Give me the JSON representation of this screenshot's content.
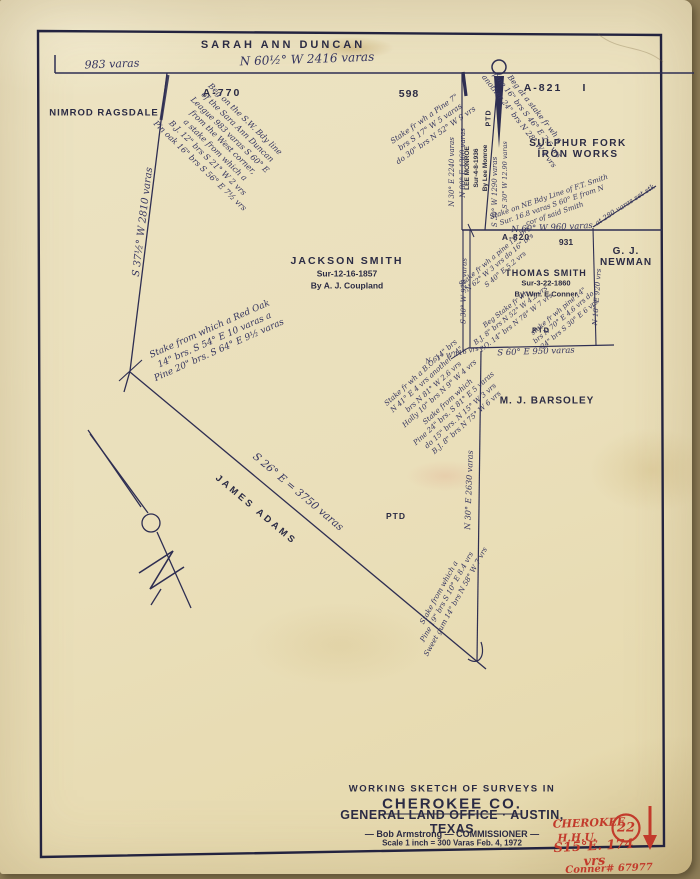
{
  "labels": {
    "sarah_ann_duncan": "SARAH ANN  DUNCAN",
    "nimrod_ragsdale": "NIMROD RAGSDALE",
    "a770": "A-770",
    "num_598": "598",
    "a821": "A-821",
    "roman_one": "I",
    "sulphur_fork": "SULPHUR FORK IRON WORKS",
    "jackson_smith_name": "JACKSON SMITH",
    "jackson_smith_sub": "Sur-12-16-1857\nBy A. J. Coupland",
    "lee_monroe": "LEE MONROE\nSur-4-8-1936\nBy Lee Monroe",
    "ptd_strip": "PTD",
    "a820": "A-820",
    "num_931": "931",
    "gj_newman": "G. J. NEWMAN",
    "thomas_smith_name": "THOMAS SMITH",
    "thomas_smith_sub": "Sur-3-22-1860\nBy Wm. E Conner",
    "ptd_block": "PTD",
    "mj_barsoley": "M. J. BARSOLEY",
    "james_adams": "JAMES ADAMS",
    "ptd_center": "PTD",
    "varas_983": "983 varas",
    "bearing_top": "N 60½° W  2416 varas",
    "bearing_left_line": "S 37½° W  2810 varas",
    "bearing_adams": "S 26° E  =  3750 varas",
    "bearing_v_2240": "N 30° E 2240 varas",
    "bearing_v_1360": "N 80° E 1360 varas",
    "bearing_v_1290a": "S 30° W 1290 varas",
    "bearing_v_1290b": "S 30° W 12.90 varas",
    "bearing_v_920": "S 30° W 920 varas",
    "bearing_v_block_right": "N 18° E 920 vrs",
    "bearing_960": "N 60° W 960 varas",
    "bearing_950": "S 60° E 950 varas",
    "bearing_116": "N 61° W 116 vrs",
    "bearing_v_2630": "N 30° E 2630 varas",
    "at_280": "at 280 varas set stk"
  },
  "notes": {
    "beg_sw": "Beg on the S.W. Bdy line\nof the Sara Ann Duncan\nLeague 983 varas S 60° E\nfrom the West corner,\na stake from which a\nB.J. 12\" brs S 21° W 2 vrs\nPin oak 16\" brs S 56° E 7½ vrs",
    "red_oak": "Stake from which a Red Oak\n14\" brs. S 54° E 10 varas a\nPine 20\" brs. S 64° E 9½ varas",
    "pine_top": "Stake fr wh a Pine 7\"\nbrs S 17° W 5 varas\ndo 30\" brs N 52° W 9 vrs",
    "beg_stake_right": "Beg at a stake fr wh a\npine 16\" brs S 46° E 2.6 vrs\nanother 24\" brs N 28° W 4 vrs",
    "ne_bdy": "Stake on NE Bdy Line of F.T. Smith\nSur. 16.8 varas S 60° E from N\ncor of said Smith",
    "block_upper": "Stake fr wh a pine 12\" brs\nN 62° W 3 vrs do 16\" brs\nS 40° E 5.2 vrs",
    "block_lower_left": "Beg Stake fr wh\nB.J. 8\" brs N 52° W 4.2 vrs\nP.O. 14\" brs N 78° W 7 vrs",
    "block_lower_right": "stake fr wh pine 14\"\nbrs N 70° E 4.6 vrs do\n24\" brs S 30° E 6 vrs",
    "mid_left": "Stake fr wh a B.O. 14\" brs\nN 41° E 4 vrs another 24\"\nbrs N 81° W 2.6 vrs\nHolly 10\" brs N 9° W 4 vrs",
    "mid_right": "Stake from which\nPine 24\" brs. S 81° E 5 varas\ndo 15\" brs. N 15° W 3 vrs\nB.J. 8\" brs N 75° W 6 vrs",
    "bottom_point": "Stake from which a\nPine 19\" brs S 10° E 8.4 vrs\nSweet gum 14\" brs N 58° W 7 vrs"
  },
  "title_block": {
    "line1": "WORKING SKETCH OF SURVEYS IN",
    "line2": "CHEROKEE CO.",
    "line3": "GENERAL LAND OFFICE · AUSTIN, TEXAS",
    "line4": "— Bob  Armstrong — COMMISSIONER —",
    "line5": "Scale 1 inch = 300 Varas     Feb. 4, 1972"
  },
  "red": {
    "county": "CHEROKEE",
    "file": "H.H.U.",
    "number": "22",
    "bearing": "S15°E.  174 vrs",
    "conner": "Conner# 67977"
  },
  "colors": {
    "ink": "#2e2e52",
    "red": "#c23a2b",
    "paper": "#ece3c3"
  }
}
